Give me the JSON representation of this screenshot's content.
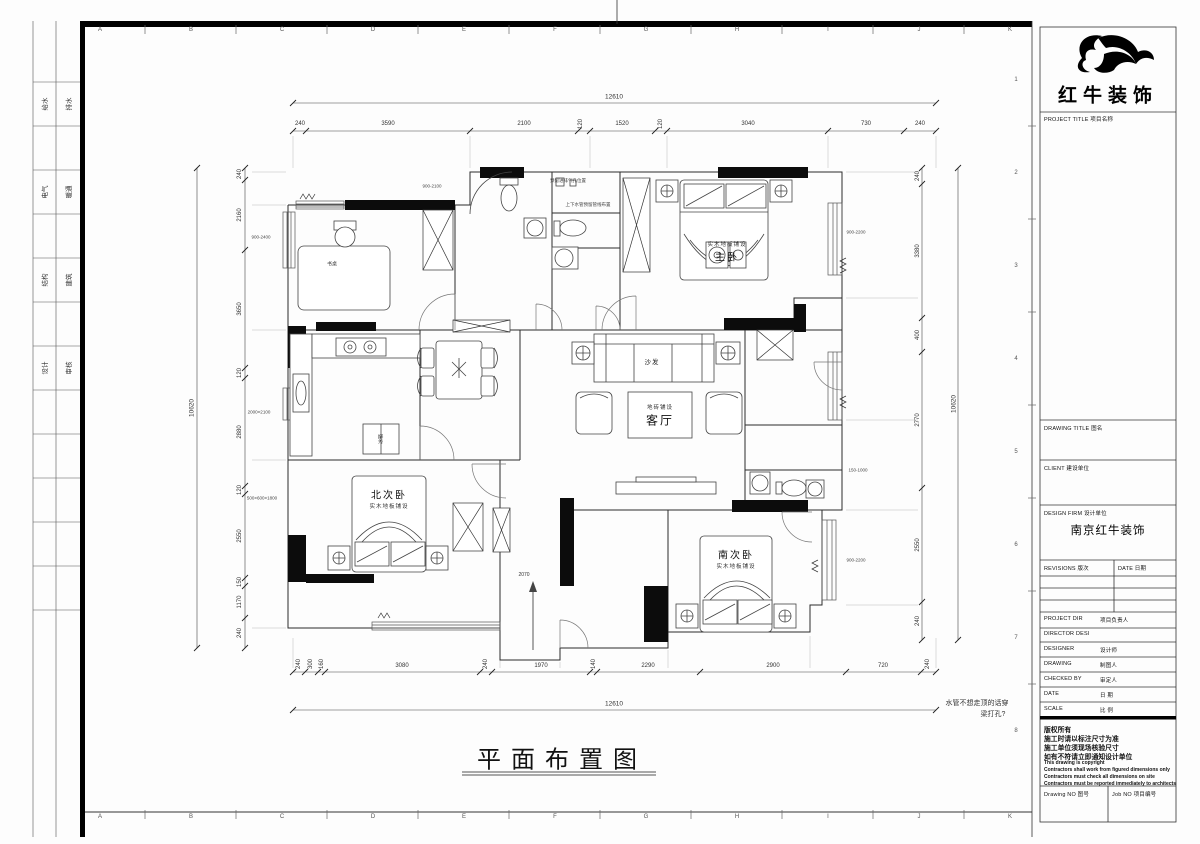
{
  "sheet": {
    "grid_letters": [
      "A",
      "B",
      "C",
      "D",
      "E",
      "F",
      "G",
      "H",
      "I",
      "J",
      "K"
    ],
    "grid_numbers": [
      "1",
      "2",
      "3",
      "4",
      "5",
      "6",
      "7",
      "8"
    ],
    "stamps": [
      {
        "left": "给水",
        "right": "排水"
      },
      {
        "left": "电气",
        "right": "暖通"
      },
      {
        "left": "结构",
        "right": "建筑"
      },
      {
        "left": "设计",
        "right": "审核"
      }
    ]
  },
  "plan": {
    "title": "平面布置图",
    "note_line1": "水管不想走顶的话穿",
    "note_line2": "梁打孔?",
    "rooms": {
      "master": "主卧",
      "master_sub": "实木地板铺设",
      "north": "北次卧",
      "north_sub": "实木地板铺设",
      "south": "南次卧",
      "south_sub": "实木地板铺设",
      "living": "客厅",
      "living_sub": "地砖铺设",
      "sofa": "沙发",
      "desk": "书桌",
      "fridge": "冰箱"
    },
    "annotations": {
      "bath_top": "预留进排气孔位置",
      "bath_mid": "上下水管预留管线布置",
      "win_top": "900-2100",
      "win_master": "900-2200",
      "win_left": "900-2400",
      "wardrobe_left": "2000×2100",
      "wardrobe_left2": "500×600×1800",
      "win_south": "900-2200",
      "right_mid": "150-1000",
      "entry": "2070"
    }
  },
  "dims": {
    "top_overall": "12610",
    "top": [
      "240",
      "3590",
      "2100",
      "120",
      "1520",
      "120",
      "3040",
      "730",
      "240"
    ],
    "bottom": [
      "240",
      "300",
      "160",
      "3080",
      "240",
      "1970",
      "140",
      "2290",
      "2900",
      "720",
      "240"
    ],
    "bottom_overall": "12610",
    "left": [
      "240",
      "2160",
      "3650",
      "120",
      "2880",
      "120",
      "2550",
      "150",
      "1170",
      "240"
    ],
    "left_overall": "10620",
    "right": [
      "240",
      "3380",
      "400",
      "2770",
      "2550",
      "240"
    ],
    "right_overall": "10620"
  },
  "titleblock": {
    "brand": "红牛装饰",
    "project_title": "PROJECT TITLE  项目名称",
    "drawing_title": "DRAWING TITLE  图名",
    "client": "CLIENT  建设单位",
    "design_firm": "DESIGN FIRM  设计单位",
    "design_firm_value": "南京红牛装饰",
    "revisions": "REVISIONS  版次",
    "revisions_date": "DATE  日期",
    "info_rows": [
      {
        "en": "PROJECT DIR",
        "cn": "项目负责人"
      },
      {
        "en": "DIRECTOR DESI",
        "cn": ""
      },
      {
        "en": "DESIGNER",
        "cn": "设计师"
      },
      {
        "en": "DRAWING",
        "cn": "制图人"
      },
      {
        "en": "CHECKED BY",
        "cn": "审定人"
      },
      {
        "en": "DATE",
        "cn": "日  期"
      },
      {
        "en": "SCALE",
        "cn": "比  例"
      }
    ],
    "copyright": [
      "版权所有",
      "施工时请以标注尺寸为准",
      "施工单位须现场核验尺寸",
      "如有不符请立即通知设计单位",
      "This drawing is copyright",
      "Contractors shall work from figured dimensions only",
      "Contractors must check all dimensions on site",
      "Contractors must be reported immediately to architects"
    ],
    "drawing_no": "Drawing NO  图号",
    "job_no": "Job NO  项目编号"
  }
}
